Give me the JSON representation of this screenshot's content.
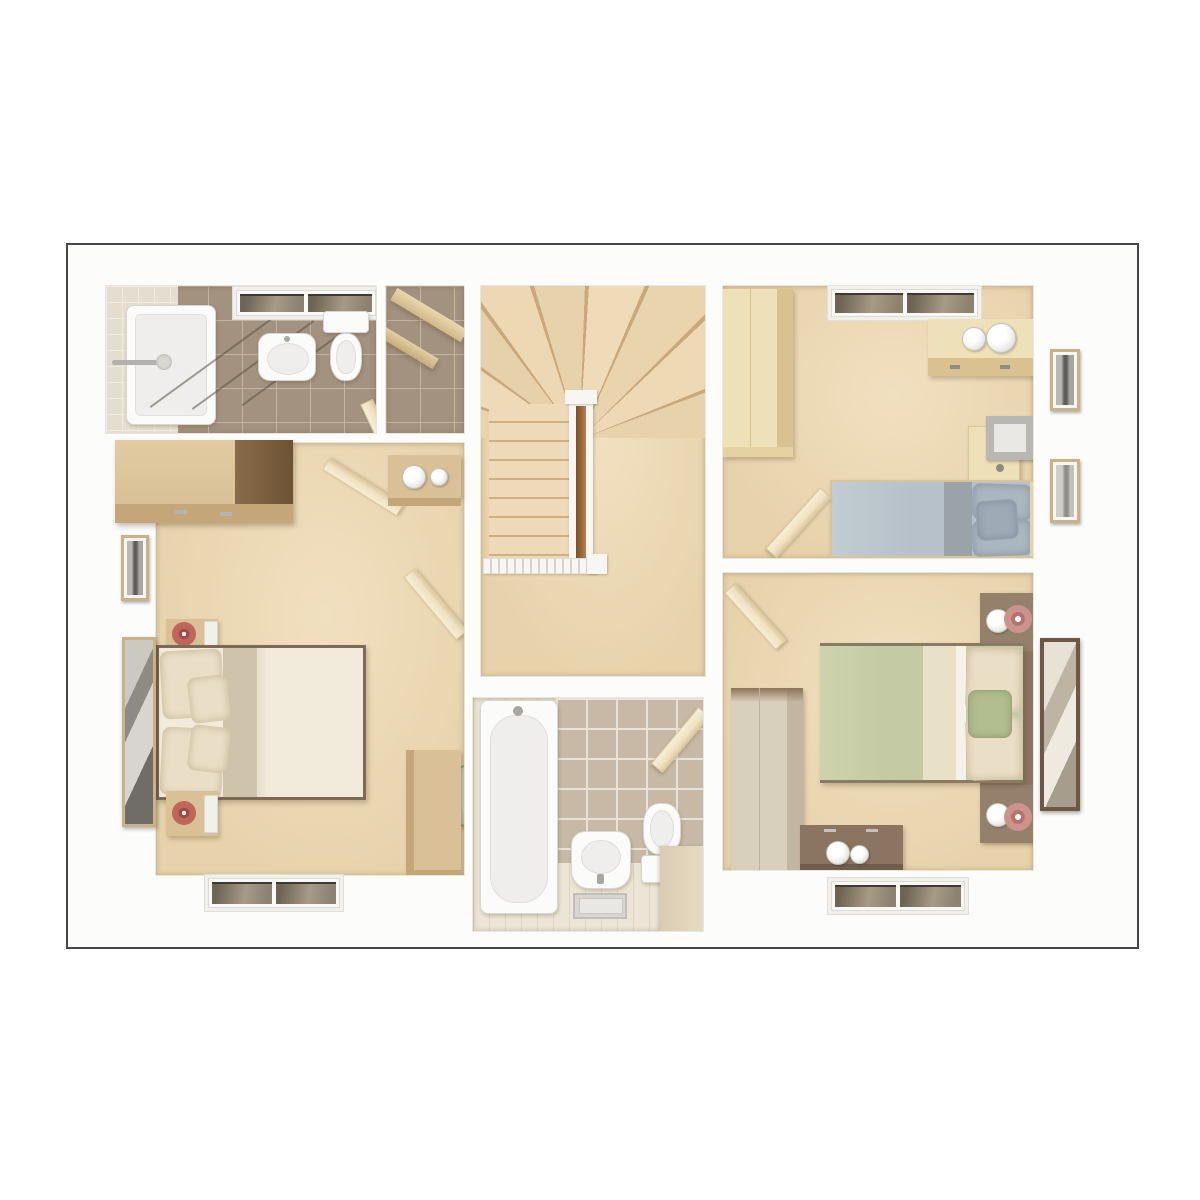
{
  "meta": {
    "type": "3d-floor-plan-rendering",
    "floor": "first-floor",
    "visible_text": ""
  },
  "colors": {
    "frameBorder": "#454545",
    "wall": "#fcfcfb",
    "carpet": "#e7d2ab",
    "carpetHi": "#f1e0c0",
    "stair": "#eedab8",
    "stairEdge": "#cfae80",
    "railWood": "#9a6b3c",
    "spindle": "#d8d4cd",
    "tileTaupe": "#a3927f",
    "tileGrout": "#c3b5a4",
    "tilePale": "#e5ded0",
    "tilePaleGrout": "#f0eadf",
    "bathTile": "#c7b9a5",
    "bathTileGrout": "#e9e2d6",
    "bathFloor": "#ece5d5",
    "bathFloorLine": "#ded5c2",
    "woodPale": "#eee0b8",
    "woodPaleSide": "#d9c28f",
    "woodMid": "#d9c096",
    "woodMidSide": "#7d5f40",
    "woodMidFront": "#c4a679",
    "woodGrey": "#d9cfbd",
    "woodDark": "#8c7560",
    "woodDarker": "#715d4b",
    "fixture": "#fbfbfa",
    "fixtureLine": "#d9d6d1",
    "fixtureInner": "#efeeec",
    "glassDark": "#6e6554",
    "glassLight": "#a89a85",
    "doorLeaf": "#f0e2c2",
    "doorLeafEdge": "#dcc9a0",
    "duvetCream": "#f2ebdb",
    "duvetFold": "#cfc3ab",
    "pillowCream": "#eadfc6",
    "pillowCreamLine": "#d8c9aa",
    "duvetBlue": "#b6c1c9",
    "duvetBlueDark": "#9aa3a8",
    "pillowBlue": "#aab6c0",
    "duvetGreen": "#c4caa3",
    "pillowGreen": "#b2bd90",
    "flowerRed": "#c0655a",
    "flowerRedDark": "#9e4a42",
    "flowerPink": "#cb938c",
    "chairGreen": "#b7bd9c",
    "chairGreenDark": "#8d9478",
    "artDark": "#5f5e5c",
    "frameGold": "#c9b188",
    "mirrorDark": "#6e5844",
    "glassLamp": "#eef0ef",
    "bedFrameDark": "#7b6a56"
  },
  "rooms": [
    {
      "id": "ensuite",
      "name": "En-suite shower room",
      "features": [
        "shower-enclosure",
        "shower-fitting",
        "washbasin",
        "toilet",
        "window",
        "tiled-floor",
        "door"
      ]
    },
    {
      "id": "airing-cupboard",
      "name": "Airing cupboard",
      "features": [
        "timber-shelves",
        "tiled-floor"
      ]
    },
    {
      "id": "master-bedroom",
      "name": "Master bedroom",
      "features": [
        "double-bed-cream",
        "wardrobe",
        "bedside-table-top",
        "bedside-table-bottom",
        "display-shelf",
        "picture-frame",
        "wall-mirror",
        "round-chair",
        "dressing-desk",
        "window",
        "door-from-landing",
        "door-to-ensuite"
      ]
    },
    {
      "id": "landing",
      "name": "Landing",
      "features": [
        "winder-staircase",
        "straight-flight",
        "banister-with-handrail",
        "spindle-rail"
      ]
    },
    {
      "id": "bathroom",
      "name": "Bathroom",
      "features": [
        "bath",
        "pedestal-basin",
        "bath-mat",
        "toilet",
        "shelf-ledge",
        "door"
      ]
    },
    {
      "id": "bedroom-2",
      "name": "Bedroom 2",
      "features": [
        "single-bed-blue",
        "wardrobe",
        "chest-with-lamps",
        "desk-with-shelf",
        "picture-frame-upper",
        "picture-frame-lower",
        "window",
        "door"
      ]
    },
    {
      "id": "bedroom-3",
      "name": "Bedroom 3",
      "features": [
        "double-bed-green",
        "headboard-panel-with-shelves",
        "glass-lamps",
        "pink-flowers",
        "wardrobe",
        "chest-of-drawers",
        "wall-mirror",
        "window",
        "door"
      ]
    }
  ]
}
